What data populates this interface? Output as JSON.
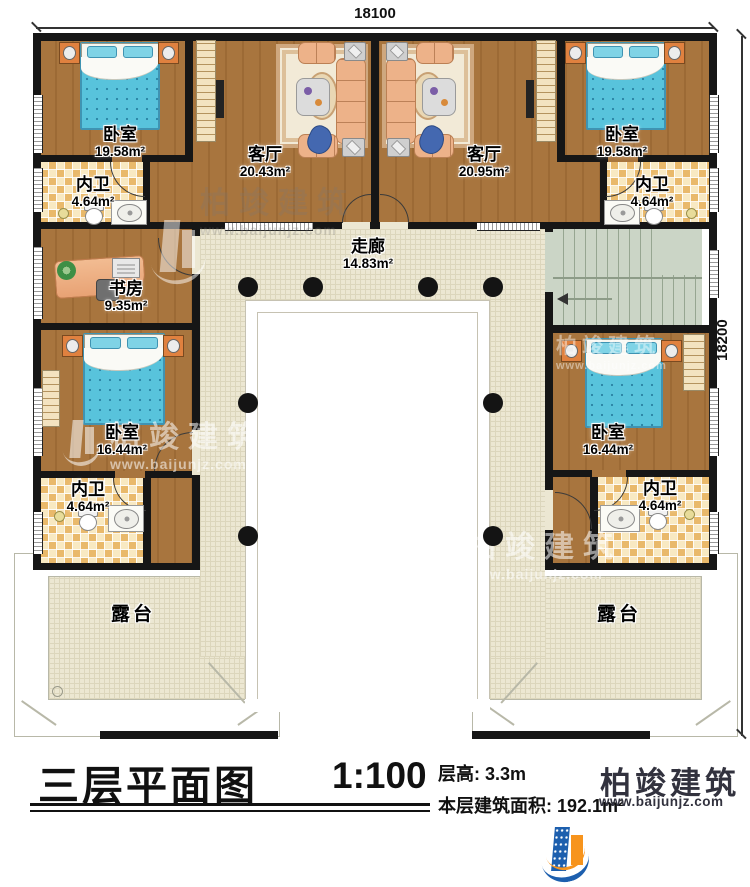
{
  "dimensions": {
    "top": "18100",
    "right": "18200"
  },
  "rooms": {
    "bedroom_tl": {
      "name": "卧室",
      "area": "19.58m²"
    },
    "living_l": {
      "name": "客厅",
      "area": "20.43m²"
    },
    "living_r": {
      "name": "客厅",
      "area": "20.95m²"
    },
    "bedroom_tr": {
      "name": "卧室",
      "area": "19.58m²"
    },
    "bath_tl": {
      "name": "内卫",
      "area": "4.64m²"
    },
    "bath_tr": {
      "name": "内卫",
      "area": "4.64m²"
    },
    "corridor": {
      "name": "走廊",
      "area": "14.83m²"
    },
    "study": {
      "name": "书房",
      "area": "9.35m²"
    },
    "bedroom_ml": {
      "name": "卧室",
      "area": "16.44m²"
    },
    "bedroom_mr": {
      "name": "卧室",
      "area": "16.44m²"
    },
    "bath_bl": {
      "name": "内卫",
      "area": "4.64m²"
    },
    "bath_br": {
      "name": "内卫",
      "area": "4.64m²"
    },
    "terrace_l": {
      "name": "露台"
    },
    "terrace_r": {
      "name": "露台"
    }
  },
  "titleblock": {
    "title": "三层平面图",
    "scale": "1:100",
    "floor_height": "层高: 3.3m",
    "floor_area": "本层建筑面积: 192.1m²"
  },
  "brand": {
    "name": "柏竣建筑",
    "url": "www.baijunjz.com"
  },
  "colors": {
    "wall": "#161616",
    "wood_floor": "#a8753e",
    "bath_tile": "#e9b96b",
    "corridor": "#ece7d2",
    "stairs": "#cbd5c6",
    "bed_blue": "#58c3dc",
    "sofa": "#edb289",
    "brand_blue": "#1d5fae",
    "brand_orange": "#f7941d"
  }
}
